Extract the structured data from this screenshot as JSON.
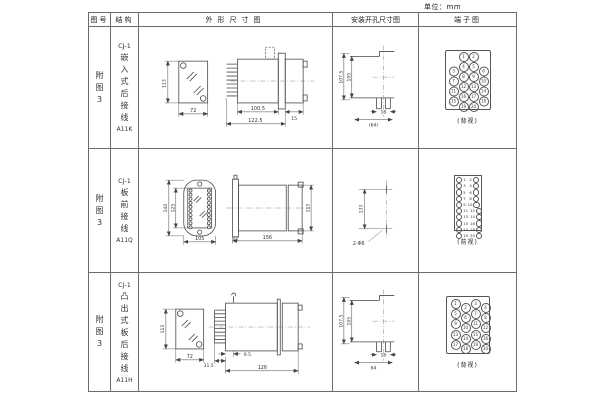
{
  "unit_label": "单位：mm",
  "headers": {
    "figure": "图号",
    "structure": "结构",
    "outline": "外形尺寸图",
    "install": "安装开孔尺寸图",
    "terminal": "端子图"
  },
  "rows": [
    {
      "figure_chars": [
        "附",
        "图",
        "3"
      ],
      "structure": {
        "model": "CJ-1",
        "type_chars": [
          "嵌",
          "入",
          "式",
          "后",
          "接",
          "线"
        ],
        "code": "A11K"
      },
      "outline": {
        "height": "113",
        "width": "72",
        "body": "100.5",
        "total": "122.5",
        "cap": "15"
      },
      "install": {
        "outer": "107.5",
        "inner": "105",
        "slot": "16",
        "span": "(64)"
      },
      "terminal": {
        "view": "(背视)",
        "cells": [
          "",
          "1",
          "2",
          "",
          "3",
          "4",
          "5",
          "6",
          "7",
          "8",
          "9",
          "10",
          "11",
          "12",
          "13",
          "14",
          "15",
          "16",
          "17",
          "18",
          "",
          "19",
          "20",
          ""
        ]
      }
    },
    {
      "figure_chars": [
        "附",
        "图",
        "3"
      ],
      "structure": {
        "model": "CJ-1",
        "type_chars": [
          "板",
          "前",
          "接",
          "线"
        ],
        "code": "A11Q"
      },
      "outline": {
        "outer_h": "140",
        "inner_h": "125",
        "width": "105",
        "length": "156",
        "side_h": "115"
      },
      "install": {
        "spacing": "133",
        "holes": "2-Φ6"
      },
      "terminal": {
        "view": "(前视)",
        "pairs": [
          {
            "l": "1",
            "r": "2"
          },
          {
            "l": "3",
            "r": "4"
          },
          {
            "l": "5",
            "r": "6"
          },
          {
            "l": "7",
            "r": "8"
          },
          {
            "l": "9",
            "r": "10"
          },
          {
            "l": "11",
            "r": "12"
          },
          {
            "l": "13",
            "r": "14"
          },
          {
            "l": "15",
            "r": "16"
          },
          {
            "l": "17",
            "r": "18"
          },
          {
            "l": "19",
            "r": "20"
          }
        ]
      }
    },
    {
      "figure_chars": [
        "附",
        "图",
        "3"
      ],
      "structure": {
        "model": "CJ-1",
        "type_chars": [
          "凸",
          "出",
          "式",
          "板",
          "后",
          "接",
          "线"
        ],
        "code": "A11H"
      },
      "outline": {
        "height": "113",
        "width": "72",
        "pins": "31.5",
        "offset": "9.5",
        "length": "126"
      },
      "install": {
        "outer": "107.5",
        "inner": "105",
        "slot": "16",
        "span": "64"
      },
      "terminal": {
        "view": "(背视)",
        "cells": [
          "1",
          "2",
          "3",
          "4",
          "5",
          "6",
          "7",
          "8",
          "9",
          "10",
          "11",
          "12",
          "13",
          "14",
          "15",
          "16",
          "17",
          "18",
          "19",
          "20"
        ]
      }
    }
  ]
}
